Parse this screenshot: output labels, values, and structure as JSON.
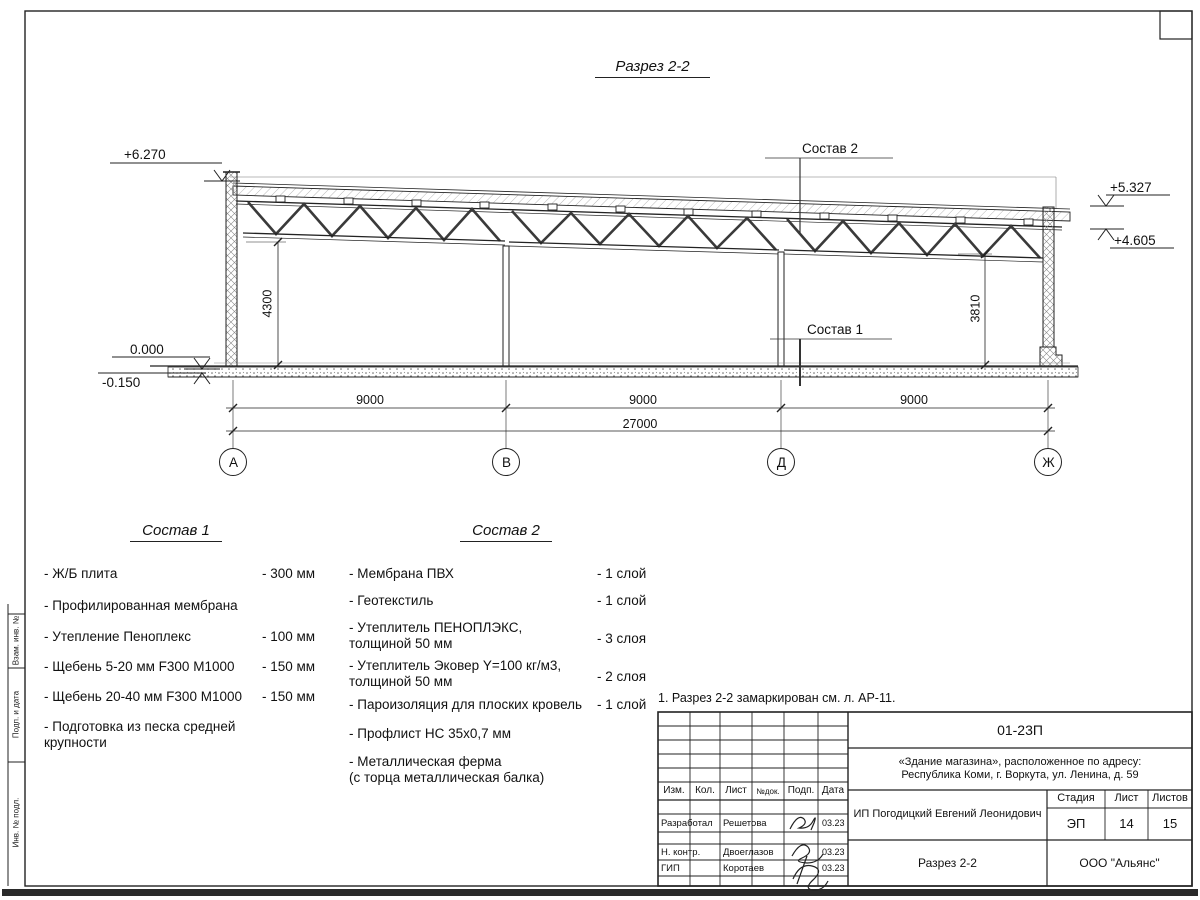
{
  "page": {
    "title": "Разрез 2-2"
  },
  "drawing": {
    "elevations": {
      "top_left": "+6.270",
      "right_upper": "+5.327",
      "right_lower": "+4.605",
      "zero": "0.000",
      "below_zero": "-0.150"
    },
    "callouts": {
      "roof": "Состав 2",
      "floor": "Состав 1"
    },
    "dims": {
      "span1": "9000",
      "span2": "9000",
      "span3": "9000",
      "total": "27000",
      "height_left": "4300",
      "height_right": "3810"
    },
    "axes": [
      "А",
      "В",
      "Д",
      "Ж"
    ]
  },
  "comp1": {
    "title": "Состав 1",
    "items": [
      {
        "name": "- Ж/Б плита",
        "value": "- 300 мм"
      },
      {
        "name": "- Профилированная мембрана",
        "value": ""
      },
      {
        "name": "- Утепление Пеноплекс",
        "value": "- 100 мм"
      },
      {
        "name": "-  Щебень 5-20 мм F300 М1000",
        "value": "- 150 мм"
      },
      {
        "name": "-  Щебень 20-40 мм F300 М1000",
        "value": "- 150 мм"
      },
      {
        "name": "- Подготовка из песка средней\n  крупности",
        "value": ""
      }
    ]
  },
  "comp2": {
    "title": "Состав 2",
    "items": [
      {
        "name": "- Мембрана ПВХ",
        "value": "- 1 слой"
      },
      {
        "name": "- Геотекстиль",
        "value": "- 1 слой"
      },
      {
        "name": "- Утеплитель ПЕНОПЛЭКС,\nтолщиной 50 мм",
        "value": "- 3 слоя"
      },
      {
        "name": "- Утеплитель Эковер Y=100 кг/м3,\nтолщиной 50 мм",
        "value": "- 2 слоя"
      },
      {
        "name": "- Пароизоляция для плоских кровель",
        "value": "- 1 слой"
      },
      {
        "name": "- Профлист НС 35х0,7 мм",
        "value": ""
      },
      {
        "name": "- Металлическая ферма\n(с торца металлическая балка)",
        "value": ""
      }
    ]
  },
  "note": "1. Разрез 2-2 замаркирован см. л. АР-11.",
  "titleblock": {
    "doc_number": "01-23П",
    "project_line1": "«Здание магазина», расположенное по адресу:",
    "project_line2": "Республика Коми, г. Воркута, ул. Ленина, д. 59",
    "header_cells": [
      "Изм.",
      "Кол.",
      "Лист",
      "№док.",
      "Подп.",
      "Дата"
    ],
    "rows": [
      {
        "role": "Разработал",
        "name": "Решетова",
        "date": "03.23"
      },
      {
        "role": "Н. контр.",
        "name": "Двоеглазов",
        "date": "03.23"
      },
      {
        "role": "ГИП",
        "name": "Коротаев",
        "date": "03.23"
      }
    ],
    "client": "ИП Погодицкий Евгений Леонидович",
    "stage_label": "Стадия",
    "sheet_label": "Лист",
    "sheets_label": "Листов",
    "stage": "ЭП",
    "sheet": "14",
    "sheets": "15",
    "sheet_title": "Разрез 2-2",
    "company": "ООО \"Альянс\""
  },
  "frame": {
    "side_labels": [
      "Взам. инв. №",
      "Подп. и дата",
      "Инв. № подл."
    ]
  }
}
